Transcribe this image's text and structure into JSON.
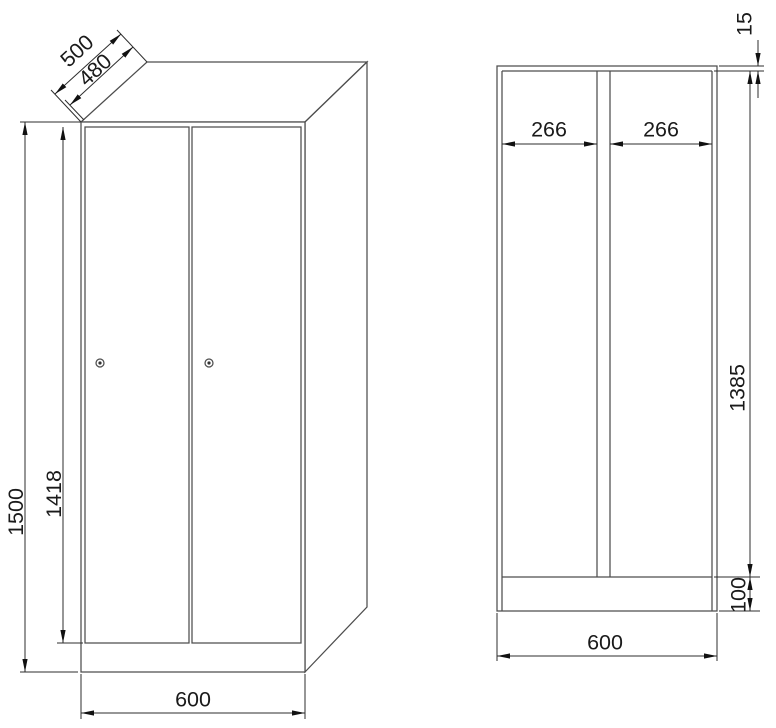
{
  "colors": {
    "background": "#ffffff",
    "geometry_lines": "#4d4d4d",
    "dimension_lines": "#2e2e2e",
    "text": "#1a1a1a"
  },
  "views": {
    "perspective": {
      "depth_total": "500",
      "depth_inner": "480",
      "height_total": "1500",
      "door_height": "1418",
      "width_total": "600"
    },
    "front": {
      "top_panel_thickness": "15",
      "left_compartment_width": "266",
      "right_compartment_width": "266",
      "interior_height": "1385",
      "plinth_height": "100",
      "width_total": "600"
    }
  }
}
